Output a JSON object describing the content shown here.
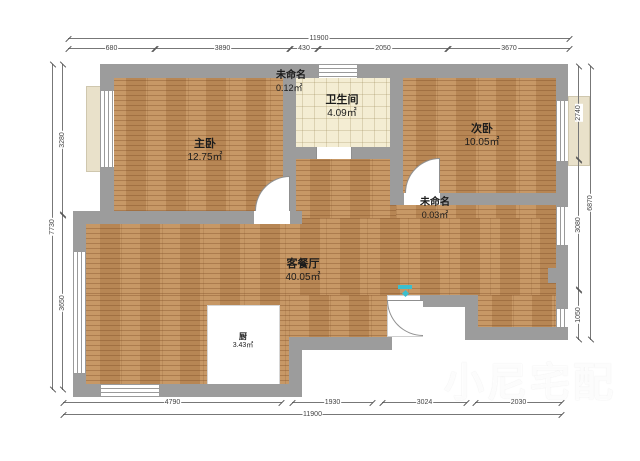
{
  "app": {
    "type": "floor-plan-viewer"
  },
  "watermark": {
    "text": "小尼宅配",
    "icon": "cube-logo-icon",
    "color": "#ffffff"
  },
  "rooms": {
    "master": {
      "name": "主卧",
      "area": "12.75㎡"
    },
    "unnamed_top": {
      "name": "未命名",
      "area": "0.12㎡"
    },
    "bath": {
      "name": "卫生间",
      "area": "4.09㎡"
    },
    "second": {
      "name": "次卧",
      "area": "10.05㎡"
    },
    "unnamed_mid": {
      "name": "未命名",
      "area": "0.03㎡"
    },
    "living": {
      "name": "客餐厅",
      "area": "40.05㎡"
    },
    "kitchen": {
      "name": "厨",
      "area": "3.43㎡"
    }
  },
  "dimensions": {
    "top": {
      "total": "11900",
      "segments": [
        "680",
        "3890",
        "430",
        "2050",
        "3670"
      ]
    },
    "bottom": {
      "total": "11900",
      "segments": [
        "4790",
        "1930",
        "3024",
        "2030"
      ]
    },
    "left": {
      "total": "7730",
      "segments": [
        "3280",
        "3650"
      ]
    },
    "right": {
      "total": "6870",
      "segments": [
        "2740",
        "3080",
        "1050"
      ]
    }
  },
  "colors": {
    "wall": "#9c9c9c",
    "wood_floor": "#c18d58",
    "tile_floor": "#f4edd3",
    "bay_window": "#e9e1ca",
    "entry_marker": "#3bbfce",
    "dimension_line": "#777777"
  }
}
